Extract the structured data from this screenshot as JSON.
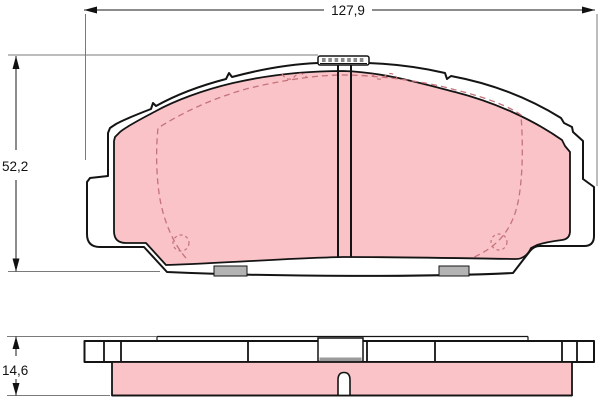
{
  "drawing": {
    "type": "technical-drawing",
    "subject": "brake-pad",
    "dimensions": {
      "width": "127,9",
      "height": "52,2",
      "thickness": "14,6"
    },
    "colors": {
      "friction_material": "#f9c3c8",
      "outline": "#141414",
      "dashed_accent": "#c4737b",
      "hardware_gray": "#b3b3b3",
      "dimension_text": "#111111",
      "background": "#ffffff"
    }
  }
}
